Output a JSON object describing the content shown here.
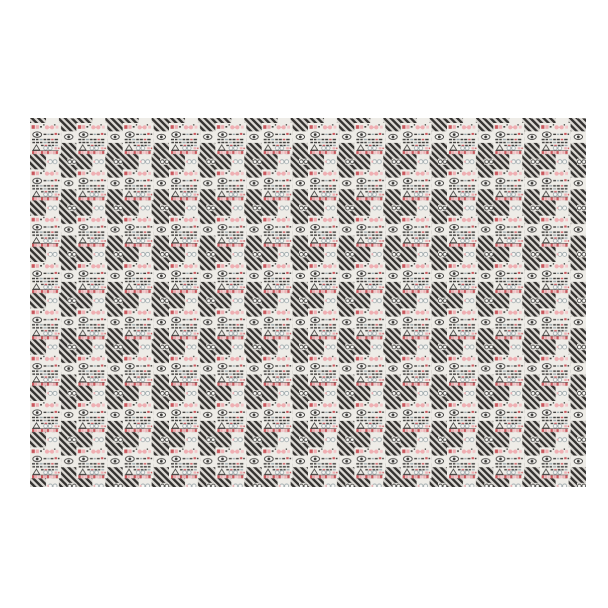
{
  "page": {
    "background": "#ffffff"
  },
  "swatch": {
    "description": "fabric-swatch-repeating-pattern",
    "left": 30,
    "top": 118,
    "width": 556,
    "height": 369,
    "unit_size": 46.33,
    "square_size": 31,
    "phase": {
      "x": 0,
      "y": 5
    },
    "palette": {
      "tile_bg": "#eeece7",
      "stripe_dark": "#353331",
      "stripe_light": "#dbd8d3",
      "red": "#c9565c",
      "pink": "#efaeb2",
      "pink_light": "#f3c5c8",
      "dark": "#3b3a38",
      "gray_blue": "#99a5a9",
      "lens": "#f7f6f3"
    },
    "stripe": {
      "period": 4.7,
      "dark_width": 2.4,
      "angle": -45
    },
    "unit_shapes": [
      {
        "name": "tile-square",
        "type": "rect",
        "x": 0,
        "y": 0,
        "w": 31,
        "h": 31,
        "fill": "tile_bg"
      },
      {
        "name": "gutter-eye-window",
        "type": "rect",
        "x": 31,
        "y": 8.3,
        "w": 15.33,
        "h": 11.6,
        "fill": "tile_bg"
      },
      {
        "name": "gutter-bottom-window",
        "type": "rect",
        "x": 16,
        "y": 31,
        "w": 13,
        "h": 15.33,
        "fill": "tile_bg"
      },
      {
        "name": "gutter-corner-window",
        "type": "rect",
        "x": 37.4,
        "y": 35.7,
        "w": 8.9,
        "h": 6,
        "fill": "tile_bg"
      },
      {
        "name": "book-red-top",
        "type": "rect",
        "x": 1.6,
        "y": 2.2,
        "w": 3.2,
        "h": 3.6,
        "fill": "red"
      },
      {
        "name": "book-pink-top",
        "type": "rect",
        "x": 5.7,
        "y": 2.2,
        "w": 3.2,
        "h": 3.6,
        "fill": "pink"
      },
      {
        "type": "rect",
        "x": 10.1,
        "y": 3,
        "w": 1.8,
        "h": 1.6,
        "fill": "dark"
      },
      {
        "type": "rect",
        "x": 13.2,
        "y": 1.2,
        "w": 1.3,
        "h": 1.3,
        "fill": "dark"
      },
      {
        "name": "pink-glasses-left-lens",
        "type": "circle",
        "cx": 17,
        "cy": 4.3,
        "r": 2.1,
        "fill": "pink"
      },
      {
        "name": "pink-glasses-right-lens",
        "type": "circle",
        "cx": 22,
        "cy": 4.3,
        "r": 2.1,
        "fill": "pink"
      },
      {
        "type": "rect",
        "x": 17,
        "y": 3.7,
        "w": 5,
        "h": 1.2,
        "fill": "pink"
      },
      {
        "type": "rect",
        "x": 25.6,
        "y": 2.6,
        "w": 2.8,
        "h": 3,
        "fill": "pink_light"
      },
      {
        "type": "rect",
        "x": 24.1,
        "y": 1.2,
        "w": 1.3,
        "h": 1.3,
        "fill": "dark"
      },
      {
        "name": "eye-outline",
        "type": "ellipse",
        "cx": 7.2,
        "cy": 11.6,
        "rx": 4.4,
        "ry": 2.7,
        "fill": "lens",
        "stroke": "dark",
        "sw": 0.9
      },
      {
        "name": "eye-pupil",
        "type": "circle",
        "cx": 7.2,
        "cy": 11.6,
        "r": 1.4,
        "fill": "dark"
      },
      {
        "type": "rect",
        "x": 13.6,
        "y": 10.7,
        "w": 2.8,
        "h": 1.3,
        "fill": "dark"
      },
      {
        "type": "rect",
        "x": 17.4,
        "y": 10.7,
        "w": 2.2,
        "h": 1.3,
        "fill": "gray_blue"
      },
      {
        "type": "rect",
        "x": 20.6,
        "y": 10.7,
        "w": 2.8,
        "h": 1.3,
        "fill": "dark"
      },
      {
        "type": "rect",
        "x": 24.6,
        "y": 9.9,
        "w": 2.4,
        "h": 2,
        "fill": "red"
      },
      {
        "type": "rect",
        "x": 27.9,
        "y": 10.5,
        "w": 1.6,
        "h": 1.4,
        "fill": "dark"
      },
      {
        "type": "rect",
        "x": 2,
        "y": 15.8,
        "w": 3,
        "h": 1.4,
        "fill": "dark"
      },
      {
        "type": "rect",
        "x": 6,
        "y": 15.8,
        "w": 2.4,
        "h": 1.4,
        "fill": "dark"
      },
      {
        "type": "rect",
        "x": 9.6,
        "y": 15.8,
        "w": 3,
        "h": 1.4,
        "fill": "gray_blue"
      },
      {
        "type": "rect",
        "x": 13.6,
        "y": 15.8,
        "w": 2.6,
        "h": 1.4,
        "fill": "dark"
      },
      {
        "type": "rect",
        "x": 17.2,
        "y": 15.8,
        "w": 3,
        "h": 1.4,
        "fill": "dark"
      },
      {
        "type": "rect",
        "x": 21.2,
        "y": 15.8,
        "w": 2.4,
        "h": 1.4,
        "fill": "red"
      },
      {
        "type": "rect",
        "x": 24.6,
        "y": 15.8,
        "w": 3.4,
        "h": 1.4,
        "fill": "dark"
      },
      {
        "type": "rect",
        "x": 2.4,
        "y": 18.8,
        "w": 2.6,
        "h": 1.4,
        "fill": "dark"
      },
      {
        "type": "rect",
        "x": 6,
        "y": 18.8,
        "w": 3,
        "h": 1.4,
        "fill": "dark"
      },
      {
        "type": "rect",
        "x": 10,
        "y": 18.8,
        "w": 2.4,
        "h": 1.4,
        "fill": "dark"
      },
      {
        "type": "rect",
        "x": 13.6,
        "y": 18.8,
        "w": 3,
        "h": 1.4,
        "fill": "gray_blue"
      },
      {
        "type": "rect",
        "x": 17.6,
        "y": 18.8,
        "w": 2.6,
        "h": 1.4,
        "fill": "dark"
      },
      {
        "type": "rect",
        "x": 21.2,
        "y": 18.8,
        "w": 3,
        "h": 1.4,
        "fill": "dark"
      },
      {
        "type": "rect",
        "x": 25.2,
        "y": 18.8,
        "w": 2.6,
        "h": 1.4,
        "fill": "dark"
      },
      {
        "type": "rect",
        "x": 11,
        "y": 21.8,
        "w": 2.6,
        "h": 1.3,
        "fill": "dark"
      },
      {
        "type": "rect",
        "x": 14.6,
        "y": 21.8,
        "w": 2.6,
        "h": 1.3,
        "fill": "red"
      },
      {
        "type": "rect",
        "x": 18.2,
        "y": 21.8,
        "w": 2.6,
        "h": 1.3,
        "fill": "dark"
      },
      {
        "type": "rect",
        "x": 21.8,
        "y": 21.8,
        "w": 2.2,
        "h": 1.3,
        "fill": "dark"
      },
      {
        "type": "rect",
        "x": 25,
        "y": 21.8,
        "w": 2.8,
        "h": 1.3,
        "fill": "gray_blue"
      },
      {
        "name": "tree-triangle",
        "type": "polygon",
        "points": "3.2,27 6.4,21.8 9.6,27",
        "fill": "none",
        "stroke": "dark",
        "sw": 0.8
      },
      {
        "name": "round-glasses-pale-left",
        "type": "circle",
        "cx": 15.6,
        "cy": 25.2,
        "r": 1.9,
        "fill": "lens",
        "stroke": "gray_blue",
        "sw": 0.8
      },
      {
        "name": "round-glasses-pale-right",
        "type": "circle",
        "cx": 20.2,
        "cy": 25.2,
        "r": 1.9,
        "fill": "lens",
        "stroke": "gray_blue",
        "sw": 0.8
      },
      {
        "type": "rect",
        "x": 17.3,
        "y": 24.8,
        "w": 1.2,
        "h": 0.7,
        "fill": "gray_blue"
      },
      {
        "type": "rect",
        "x": 24.6,
        "y": 24.2,
        "w": 2.6,
        "h": 2.2,
        "fill": "pink"
      },
      {
        "type": "rect",
        "x": 28.1,
        "y": 24.6,
        "w": 1.4,
        "h": 1.4,
        "fill": "red"
      },
      {
        "name": "books-shelf-line",
        "type": "rect",
        "x": 2,
        "y": 27.4,
        "w": 26.6,
        "h": 0.5,
        "fill": "dark"
      },
      {
        "name": "book-row",
        "type": "rect",
        "x": 2,
        "y": 28,
        "w": 2.4,
        "h": 3,
        "fill": "red"
      },
      {
        "type": "rect",
        "x": 4.95,
        "y": 28,
        "w": 2.4,
        "h": 3,
        "fill": "pink"
      },
      {
        "type": "rect",
        "x": 7.9,
        "y": 28,
        "w": 2.4,
        "h": 3,
        "fill": "pink_light"
      },
      {
        "type": "rect",
        "x": 10.85,
        "y": 28,
        "w": 2.4,
        "h": 3,
        "fill": "red"
      },
      {
        "type": "rect",
        "x": 13.8,
        "y": 28,
        "w": 2.4,
        "h": 3,
        "fill": "pink"
      },
      {
        "type": "rect",
        "x": 16.75,
        "y": 28,
        "w": 2.4,
        "h": 3,
        "fill": "red"
      },
      {
        "type": "rect",
        "x": 19.7,
        "y": 28,
        "w": 2.4,
        "h": 3,
        "fill": "pink_light"
      },
      {
        "type": "rect",
        "x": 22.65,
        "y": 28,
        "w": 2.4,
        "h": 3,
        "fill": "pink"
      },
      {
        "type": "rect",
        "x": 25.6,
        "y": 28,
        "w": 2.4,
        "h": 3,
        "fill": "red"
      },
      {
        "name": "gutter-eye-outline",
        "type": "ellipse",
        "cx": 38.7,
        "cy": 13.9,
        "rx": 4.2,
        "ry": 2.6,
        "fill": "lens",
        "stroke": "dark",
        "sw": 0.9
      },
      {
        "name": "gutter-eye-pupil",
        "type": "circle",
        "cx": 38.7,
        "cy": 13.9,
        "r": 1.4,
        "fill": "dark"
      },
      {
        "name": "gutter-glasses-pale-left",
        "type": "circle",
        "cx": 20.3,
        "cy": 38.7,
        "r": 2,
        "fill": "lens",
        "stroke": "gray_blue",
        "sw": 0.8
      },
      {
        "name": "gutter-glasses-pale-right",
        "type": "circle",
        "cx": 25,
        "cy": 38.7,
        "r": 2,
        "fill": "lens",
        "stroke": "gray_blue",
        "sw": 0.8
      },
      {
        "type": "rect",
        "x": 21.9,
        "y": 38.2,
        "w": 1.4,
        "h": 0.7,
        "fill": "gray_blue"
      },
      {
        "type": "rect",
        "x": 17.2,
        "y": 37.6,
        "w": 1.6,
        "h": 2,
        "fill": "pink"
      },
      {
        "name": "gutter-glasses-dark-left",
        "type": "circle",
        "cx": 39.7,
        "cy": 38.7,
        "r": 1.9,
        "fill": "lens",
        "stroke": "dark",
        "sw": 0.8
      },
      {
        "name": "gutter-glasses-dark-right",
        "type": "circle",
        "cx": 44.2,
        "cy": 38.7,
        "r": 1.9,
        "fill": "lens",
        "stroke": "dark",
        "sw": 0.8
      },
      {
        "type": "rect",
        "x": 41.3,
        "y": 38.2,
        "w": 1.2,
        "h": 0.7,
        "fill": "dark"
      }
    ]
  }
}
